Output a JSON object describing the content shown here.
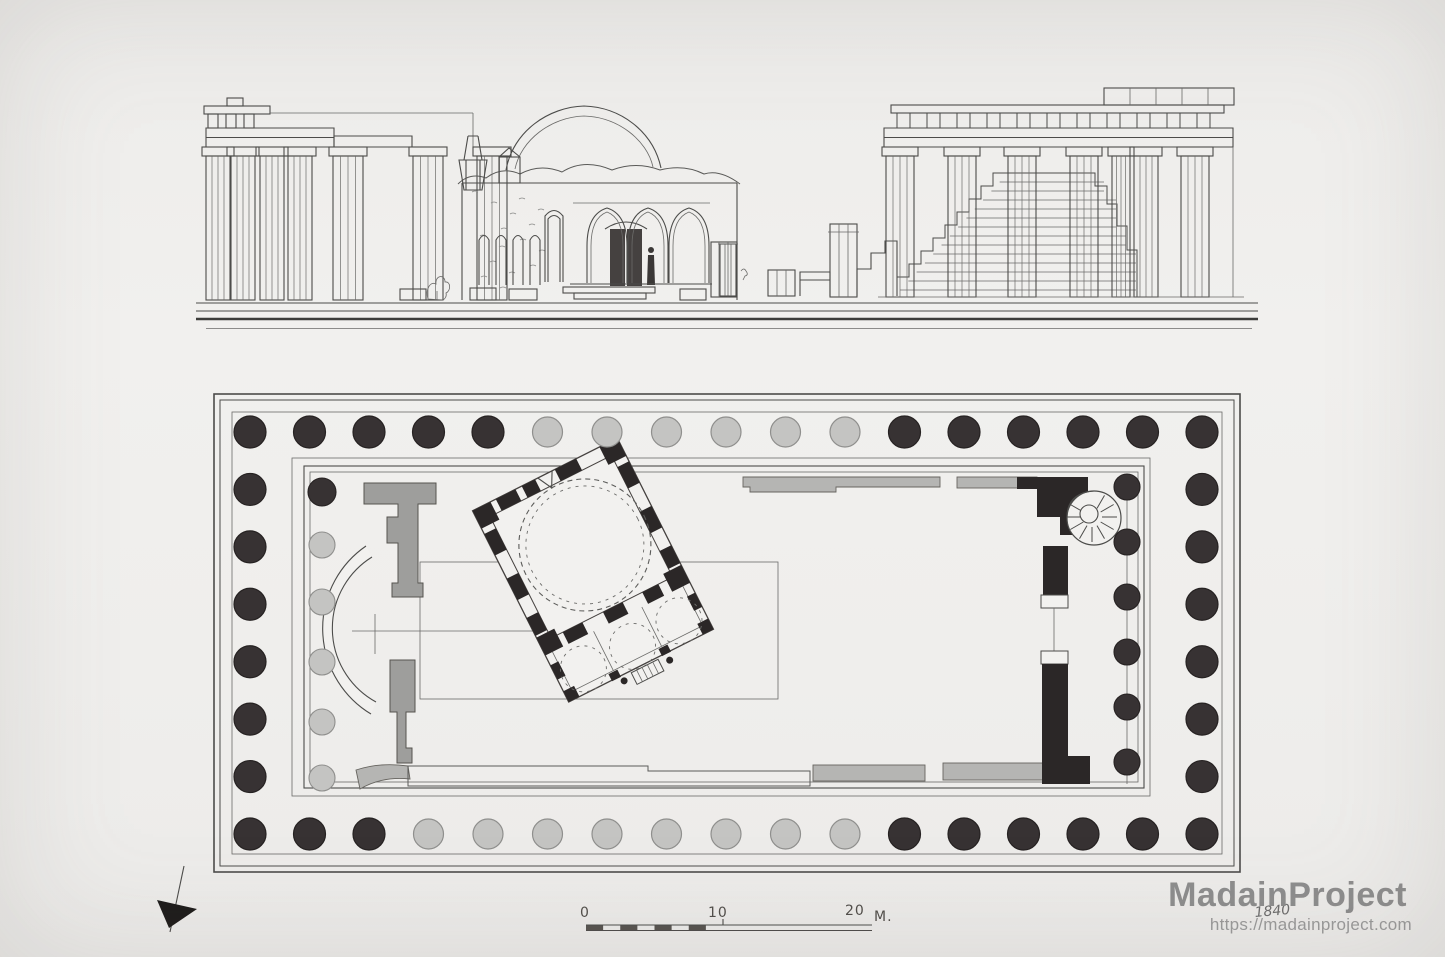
{
  "page": {
    "background": "#f0efed"
  },
  "watermark": {
    "brand": "MadainProject",
    "url": "https://madainproject.com",
    "handwritten_note": "1840",
    "brand_color": "#8d8d8d",
    "url_color": "#9a9a9a"
  },
  "scale_bar": {
    "labels": [
      "0",
      "10",
      "20"
    ],
    "unit": "M."
  },
  "drawing": {
    "ink": "#4c4c4a",
    "plan": {
      "colors": {
        "dark_column": "#373233",
        "light_column": "#c4c4c2",
        "wall_gray": "#9e9e9c",
        "black_wall": "#2b2727"
      },
      "peristyle": {
        "columns_long_side": 17,
        "columns_short_side": 8,
        "north_shades": "DDDDDLLLLLLDDDDDD",
        "south_shades": "DDDLLLLLLLLDDDDDD",
        "west_shades": "DDDDDDDD",
        "east_shades": "DDDDDDDD"
      },
      "west_porch_shades": "DLLLLL",
      "east_porch_shades": "DDDDDD",
      "mosque": {
        "porch_domes": 3,
        "has_main_dome": true,
        "rotation_deg": -26.7
      },
      "features": [
        "apse",
        "spiral-staircase",
        "cross-mark",
        "north-arrow"
      ]
    },
    "elevation": {
      "left_columns": 7,
      "right_columns": 7,
      "porch_arches": 3,
      "left_wall_windows": 4,
      "has_dome": true,
      "has_minaret_stub": true
    }
  }
}
